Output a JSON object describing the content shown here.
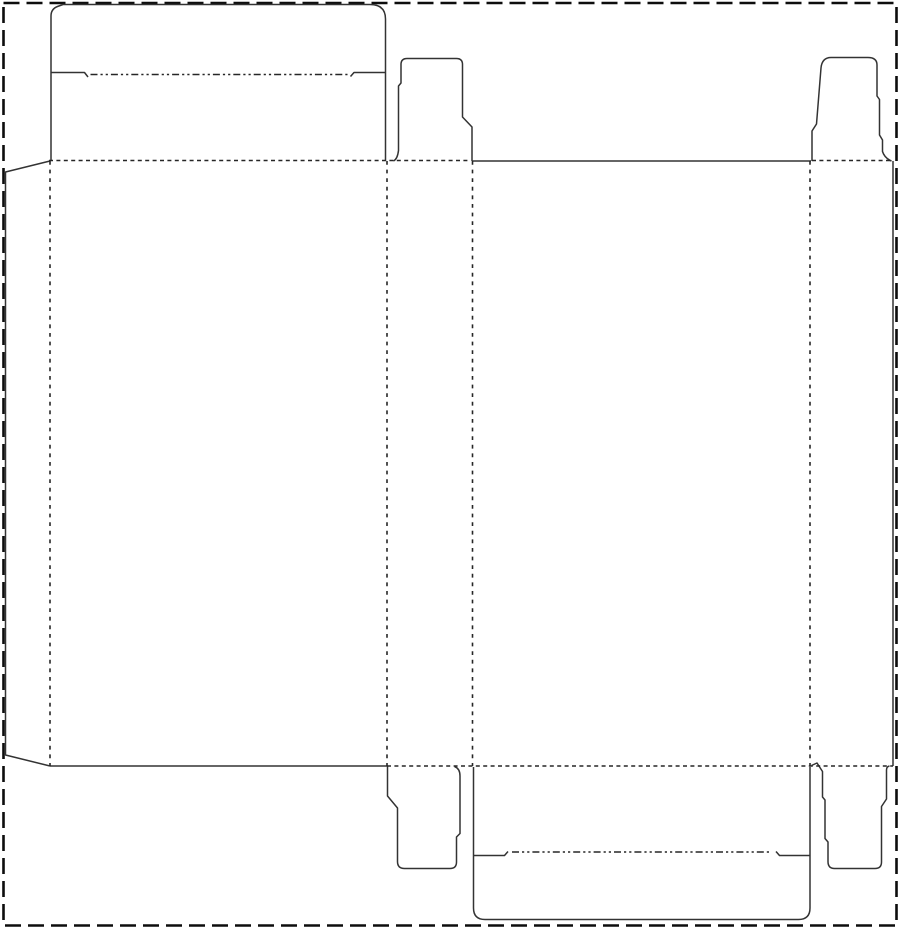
{
  "canvas": {
    "width": 900,
    "height": 929,
    "background": "#ffffff"
  },
  "line_styles": {
    "border": {
      "color": "#0d0d0d",
      "width": 2.6,
      "dash": "16 7"
    },
    "cut": {
      "color": "#333333",
      "width": 1.5,
      "dash": ""
    },
    "fold_h": {
      "color": "#262626",
      "width": 1.5,
      "dash": "4 3.4"
    },
    "fold_v": {
      "color": "#262626",
      "width": 1.6,
      "dash": "3.8 4.8"
    },
    "tuck_fold": {
      "color": "#262626",
      "width": 1.6,
      "dash": "7 3 2.2 3 2.2 3"
    }
  },
  "dieline": {
    "shapes": [
      {
        "name": "sheet-border",
        "kind": "border",
        "d": "M 3.5 3 H 896.5 V 925.5 H 3.5 Z"
      },
      {
        "name": "glue-flap-edge",
        "kind": "cut",
        "d": "M 50 161 L 5.5 172 V 755 L 50 766"
      },
      {
        "name": "tuck-lid-outline",
        "kind": "cut",
        "d": "M 51 161 V 16 Q 51 9 57.5 6.5 L 63 4.5 H 370 Q 385.5 4.5 385.5 19 V 161"
      },
      {
        "name": "tuck-lid-shoulder-left",
        "kind": "cut",
        "d": "M 51 72.5 H 84.5 L 88 77"
      },
      {
        "name": "tuck-lid-shoulder-right",
        "kind": "cut",
        "d": "M 385.5 72.5 H 354 L 350.5 76.5"
      },
      {
        "name": "top-dust-flap-left",
        "kind": "cut",
        "d": "M 393.5 161 Q 397.5 159 398.5 150.5 V 86 L 401 83 V 64.5 Q 401 58.5 407 58.5 H 456.5 Q 462.5 58.5 462.5 64.5 V 117 L 472 127 V 161"
      },
      {
        "name": "front-panel-top-edge",
        "kind": "cut",
        "d": "M 472.5 161 H 811"
      },
      {
        "name": "top-dust-flap-right",
        "kind": "cut",
        "d": "M 812 161 V 131 L 816.5 124 L 821 68 Q 822 57.5 831 57.5 H 868 Q 877 57.5 877 65 V 96 L 879.5 99.5 V 135 L 882.5 140 V 151.5 Q 884.5 158 891.5 161"
      },
      {
        "name": "right-panel-side-edge",
        "kind": "cut",
        "d": "M 893 161 V 766"
      },
      {
        "name": "back-panel-bottom-edge",
        "kind": "cut",
        "d": "M 50 766 H 387"
      },
      {
        "name": "bottom-dust-flap-left",
        "kind": "cut",
        "d": "M 387.5 766.5 V 796 L 397.5 808 V 861.5 Q 397.5 868.5 404.5 868.5 H 450 Q 456.5 868.5 456.5 862 V 837 L 460 833.5 V 776 Q 460 768.5 454.5 766.5"
      },
      {
        "name": "bottom-tuck-flap-outline",
        "kind": "cut",
        "d": "M 473.5 767 V 908 Q 473.5 919.5 485 919.5 H 798.5 Q 810 919.5 810 908 V 767"
      },
      {
        "name": "bottom-flap-shoulder-left",
        "kind": "cut",
        "d": "M 474 855.5 H 504.5 L 508 851.5"
      },
      {
        "name": "bottom-flap-shoulder-right",
        "kind": "cut",
        "d": "M 810 855.5 H 779.5 L 776 851.5"
      },
      {
        "name": "bottom-dust-flap-right",
        "kind": "cut",
        "d": "M 811.5 765.5 L 817 763 L 822.5 771.5 V 797 L 825 800 V 838.5 L 828 842 V 861.5 Q 828 868.5 834.5 868.5 H 875 Q 881.5 868.5 881.5 862 V 806.5 L 886.5 799 V 770 Q 886.5 766.5 889.5 766"
      },
      {
        "name": "tuck-lid-fold",
        "kind": "tuck_fold",
        "d": "M 90.5 74.5 H 348"
      },
      {
        "name": "bottom-flap-tuck-fold",
        "kind": "tuck_fold",
        "d": "M 512 852 H 771"
      },
      {
        "name": "fold-top-back-panel",
        "kind": "fold_h",
        "d": "M 49 160.5 H 470"
      },
      {
        "name": "fold-top-right-panel",
        "kind": "fold_h",
        "d": "M 812 160.5 H 893"
      },
      {
        "name": "fold-bottom-panels",
        "kind": "fold_h",
        "d": "M 387 766 H 893"
      },
      {
        "name": "fold-glue-flap",
        "kind": "fold_v",
        "d": "M 50 161 V 766"
      },
      {
        "name": "fold-back-to-side",
        "kind": "fold_v",
        "d": "M 387 161 V 766"
      },
      {
        "name": "fold-side-to-front",
        "kind": "fold_v",
        "d": "M 472.5 161 V 766"
      },
      {
        "name": "fold-front-to-right",
        "kind": "fold_v",
        "d": "M 810 161 V 766"
      }
    ]
  }
}
